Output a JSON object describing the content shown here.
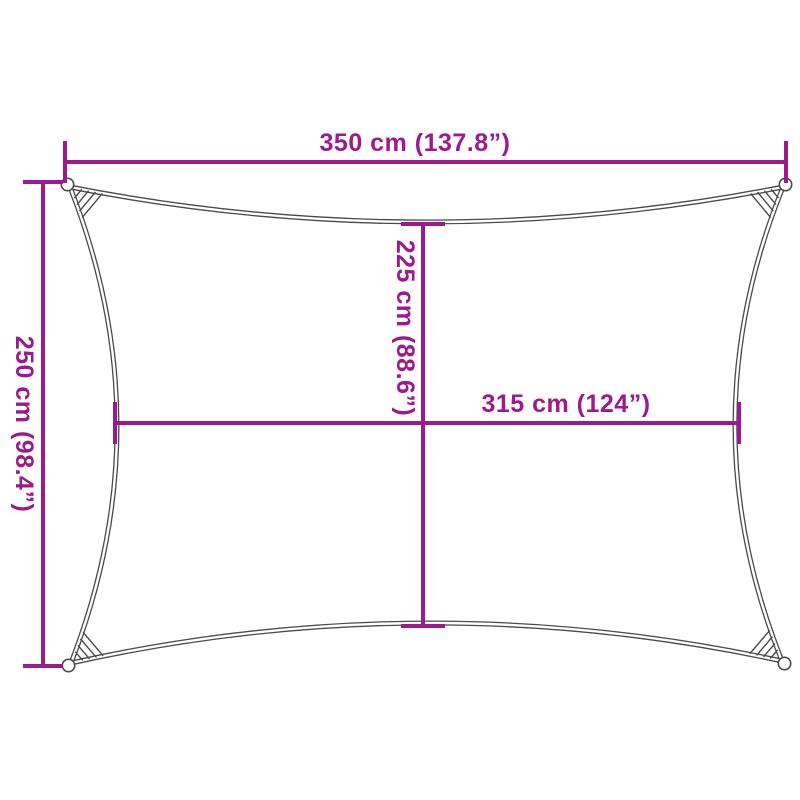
{
  "diagram": {
    "kind": "shade-sail-dimension-diagram",
    "background_color": "#ffffff",
    "accent_color": "#9B1A8D",
    "outline_color": "#4A4A4A",
    "dimension_labels": {
      "top_width": "350 cm (137.8”)",
      "left_height": "250 cm (98.4”)",
      "center_height": "225 cm (88.6”)",
      "center_width": "315 cm (124”)"
    },
    "measurements": {
      "top_width_cm": 350,
      "top_width_in": 137.8,
      "left_height_cm": 250,
      "left_height_in": 98.4,
      "center_height_cm": 225,
      "center_height_in": 88.6,
      "center_width_cm": 315,
      "center_width_in": 124
    }
  }
}
